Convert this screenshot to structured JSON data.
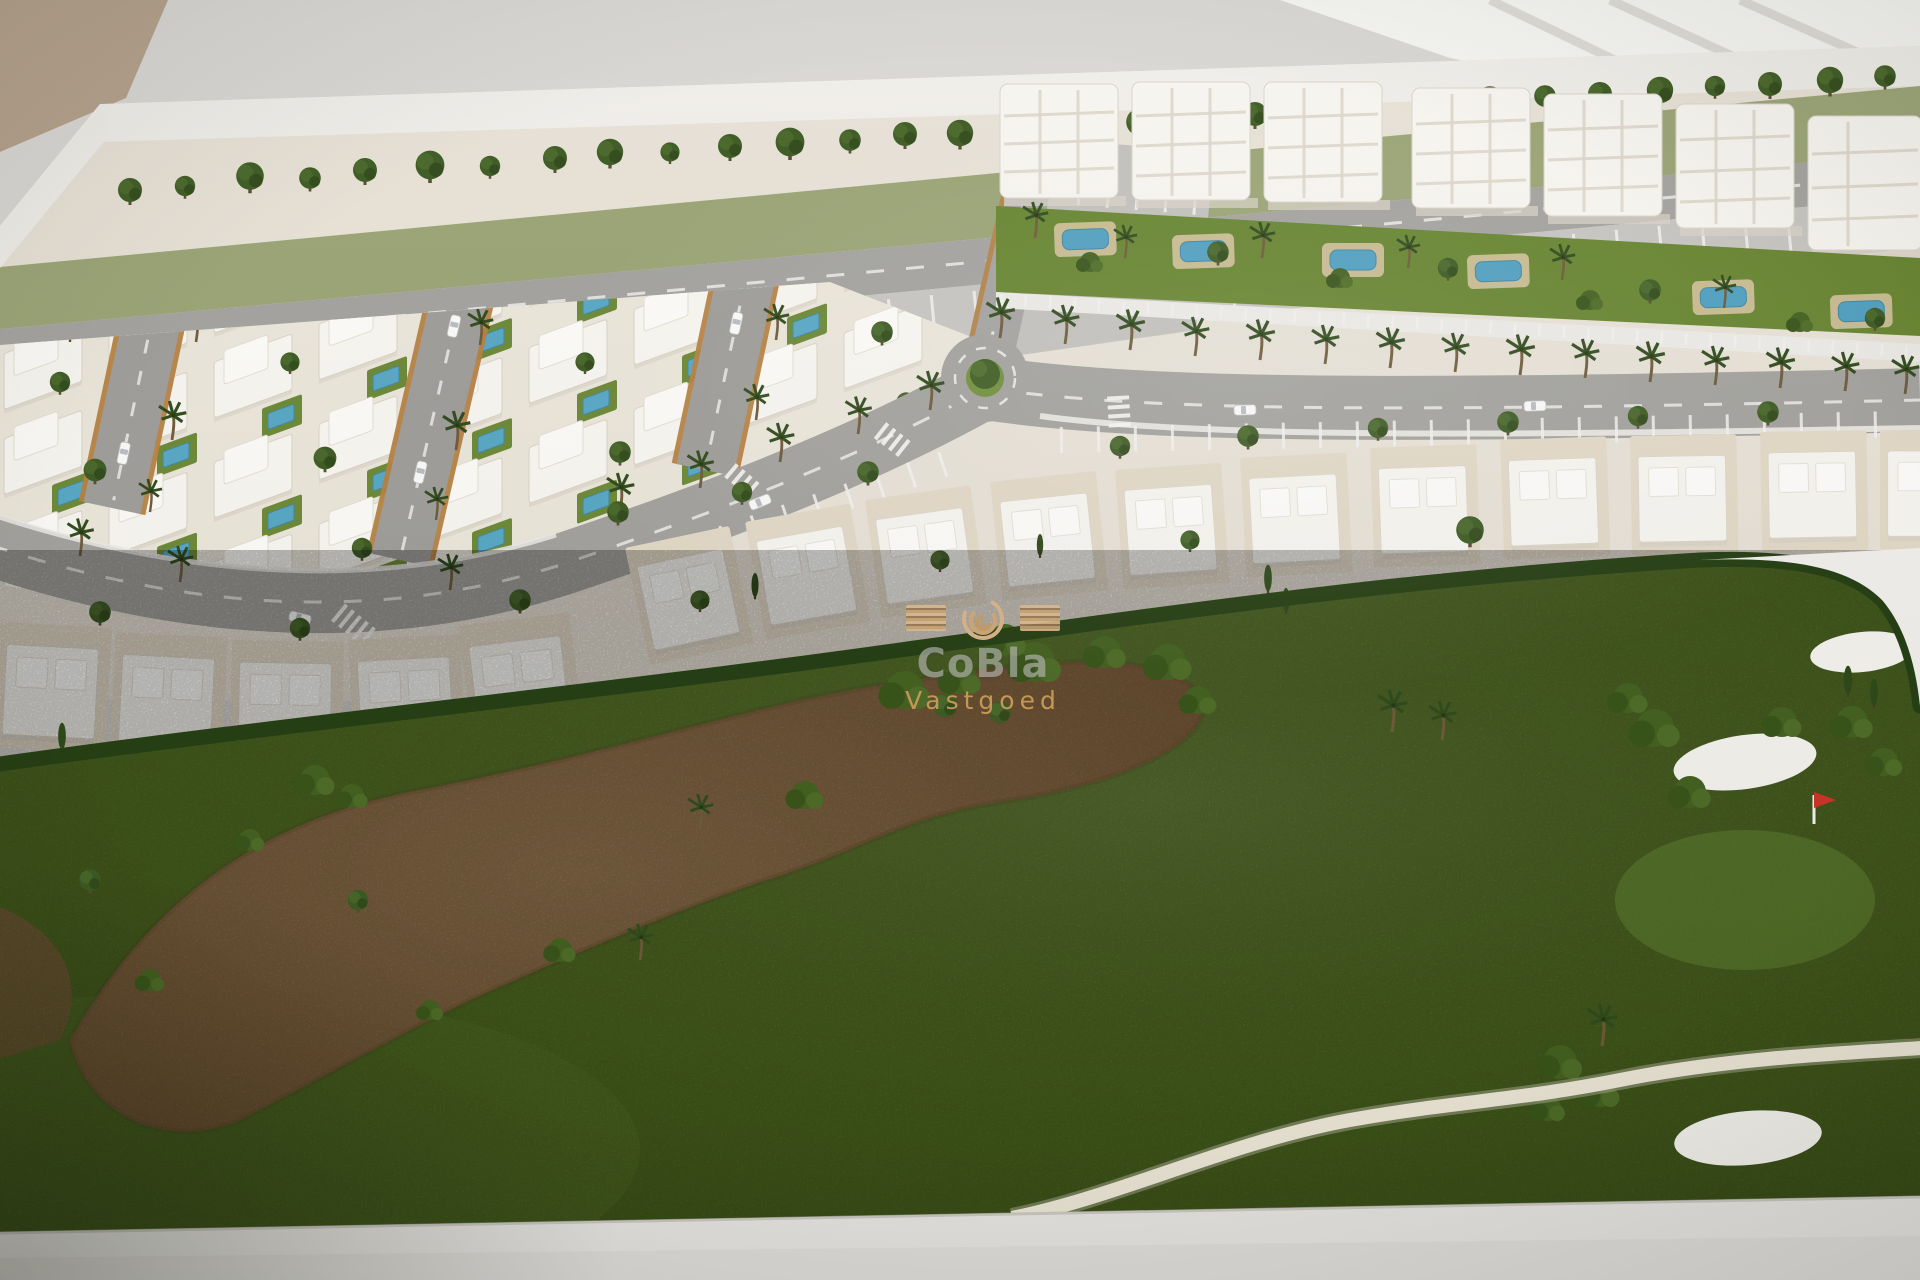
{
  "watermark": {
    "brand": "CoBla",
    "subtitle": "Vastgoed"
  },
  "scene": {
    "description": "Aerial photograph of an architectural scale model: white villa district with three loop streets, apartment blocks with pools, palm-lined avenue with roundabout, townhouse row and a golf course with sand waste area, bunkers and a red flag."
  },
  "palette": {
    "wall": "#d9d7d4",
    "wall_tan": "#b3a08a",
    "base_white": "#f0eeea",
    "lot_beige": "#e7e1d6",
    "road": "#a2a19d",
    "parking": "#c6c4c0",
    "building_white": "#f7f5f0",
    "brick_edge": "#b5803f",
    "grass": "#547122",
    "hedge": "#243d12",
    "tree_dark": "#3c5a22",
    "sand": "#8e6d45",
    "pool_blue": "#4f9fc0",
    "pool_deck": "#d3c19c",
    "bunker_white": "#f3f2ed",
    "flag_red": "#cc3326",
    "cart_path": "#ece6d6",
    "watermark_gold": "#c89a55"
  }
}
